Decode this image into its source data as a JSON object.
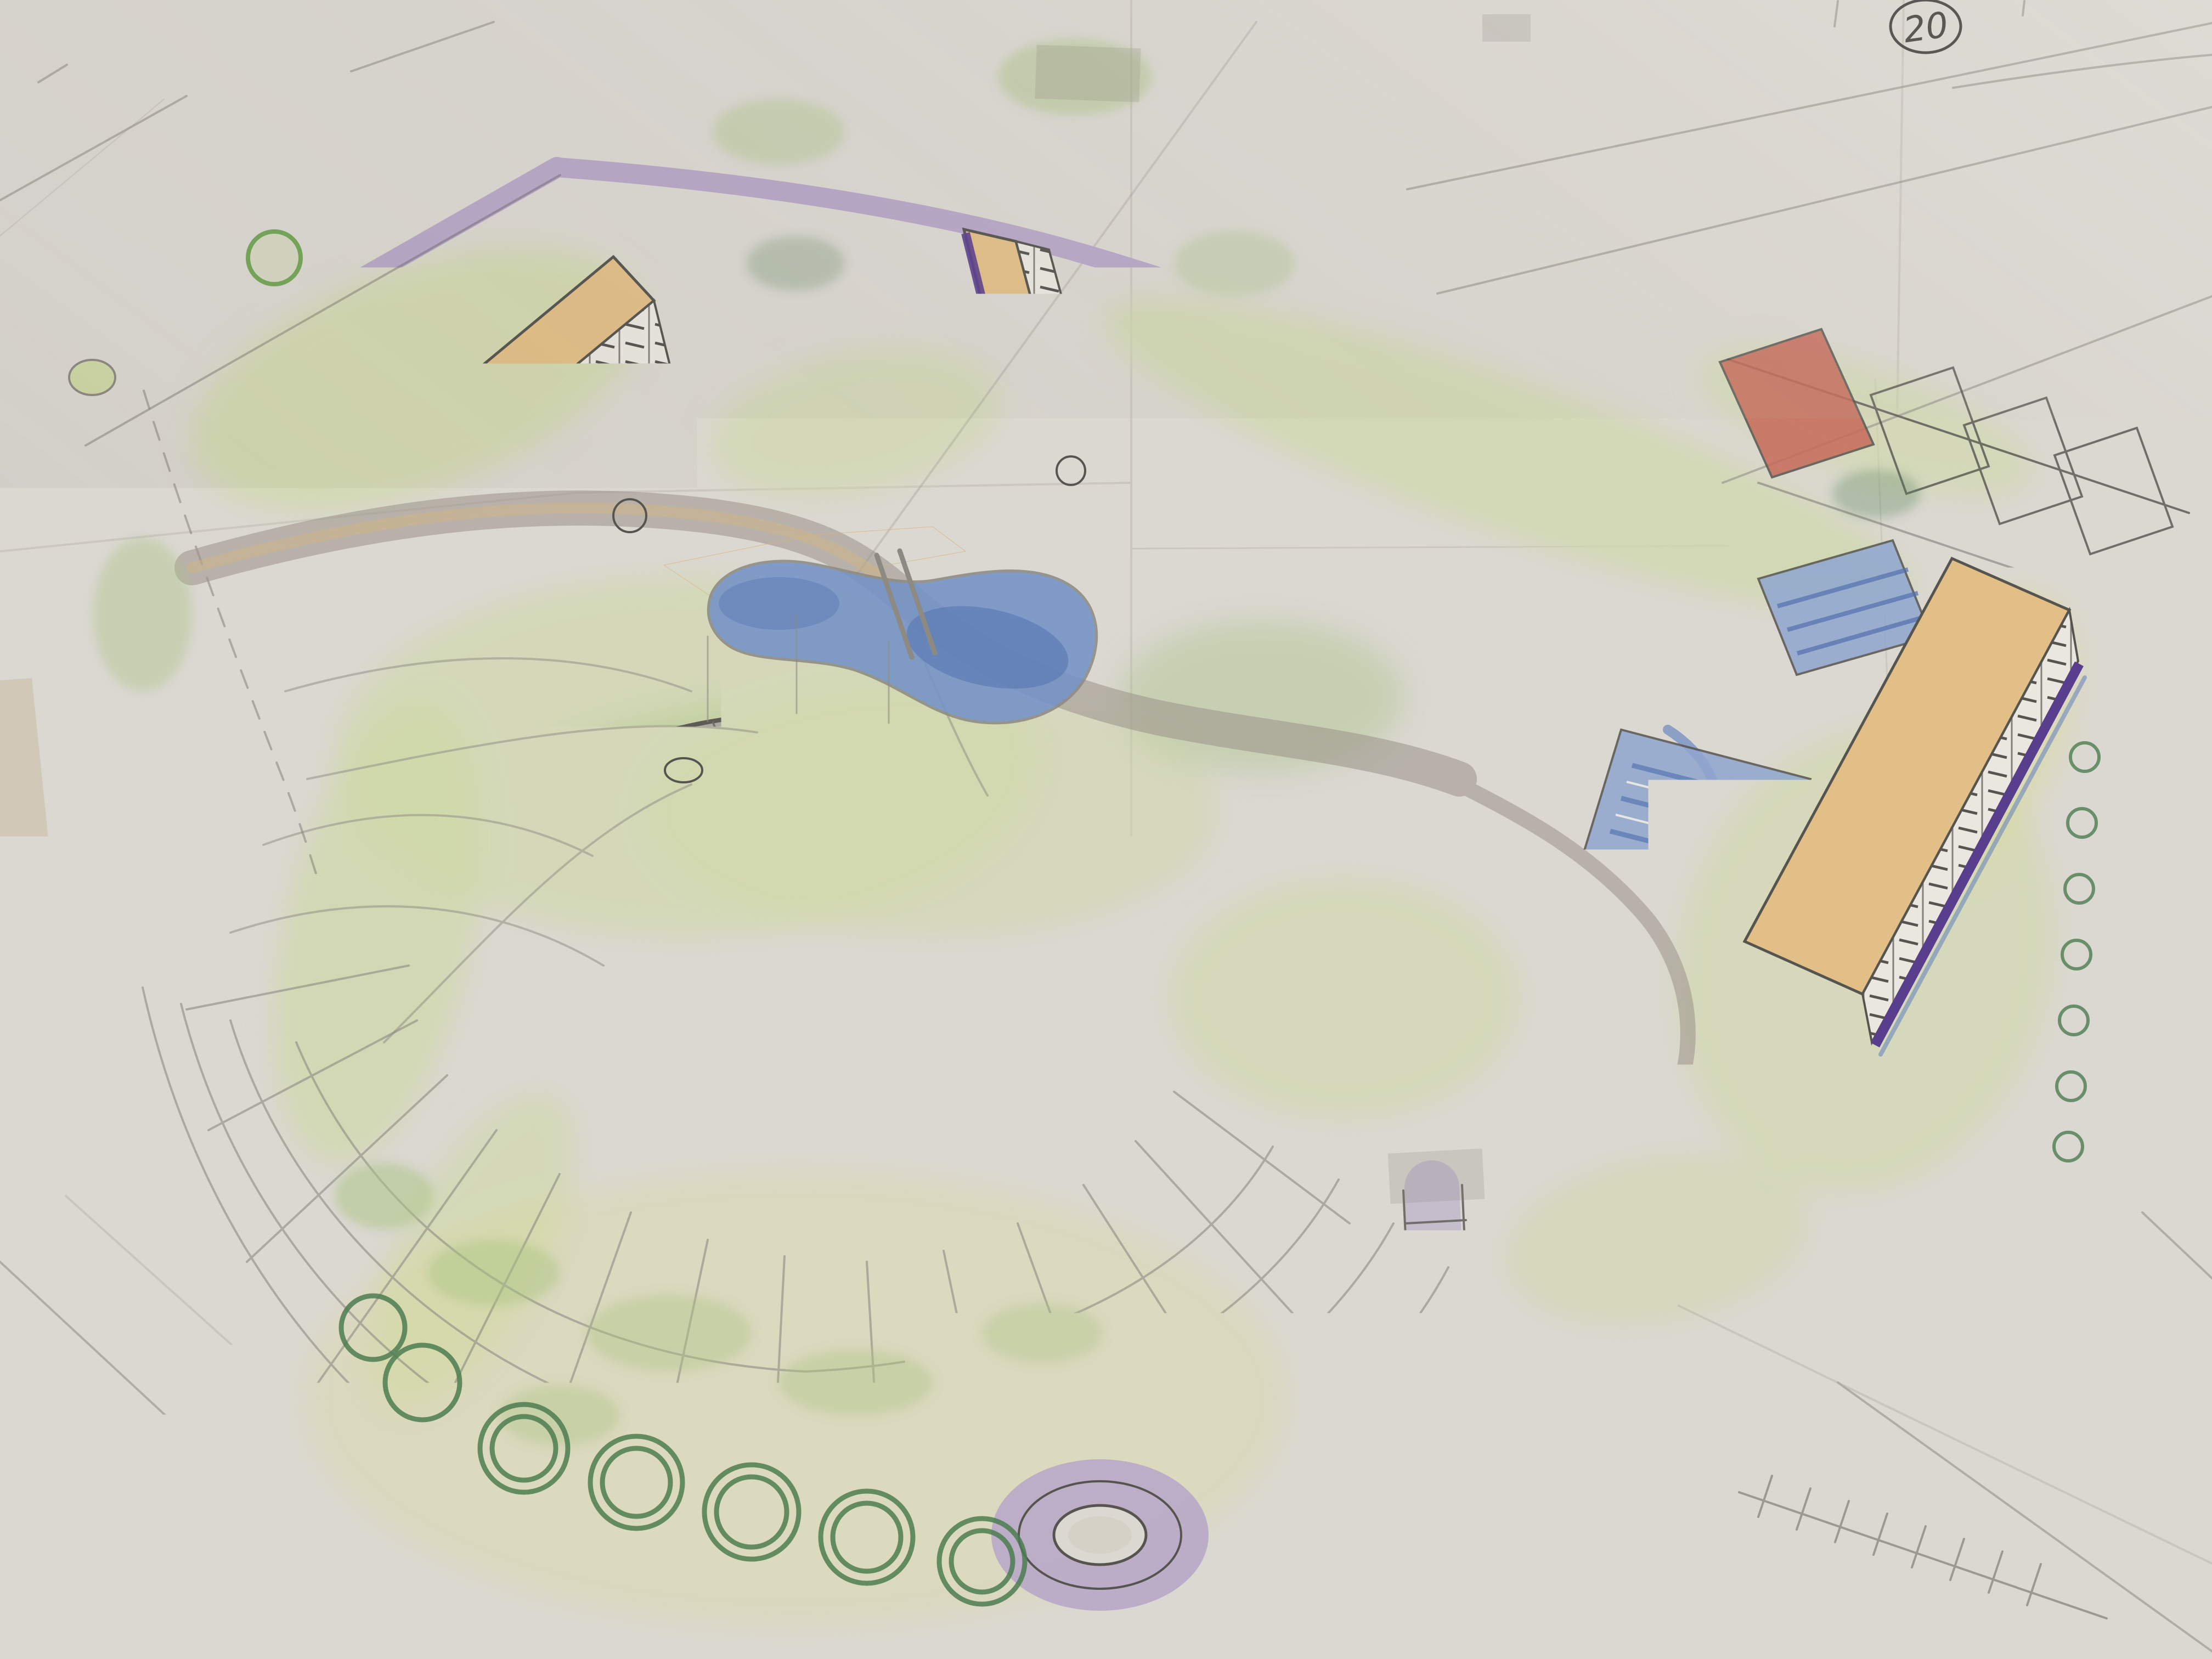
{
  "annotation": {
    "sheet_number": "20"
  },
  "scene": {
    "description": "hand-drawn colored-pencil aerial site sketch on taped paper sheets",
    "landmarks": [
      "domed-arena",
      "radial-plaza-paving",
      "bent-slab-building-nw",
      "bent-slab-building-n",
      "slab-building-e",
      "barrel-vault-hall-small",
      "barrel-vault-hall-large",
      "low-pavilion",
      "kidney-pond",
      "boulevard-with-u-turn",
      "roundabout",
      "tree-rows",
      "parking-stalls",
      "blue-courts",
      "swimming-pool",
      "red-court",
      "gridded-walkway"
    ]
  },
  "palette": {
    "paper": "#dbd8d2",
    "paper_light": "#e4e1db",
    "table": "#d2c8b8",
    "table_light": "#eae7e1",
    "graphite": "#56544f",
    "graphite_light": "#8d8a83",
    "lavender": "#b7a8c7",
    "purple_edge": "#84699e",
    "deep_purple": "#5a3e8e",
    "lawn": "#cfd8a6",
    "lawn_strong": "#a9c481",
    "lawn_yellow": "#dcdc92",
    "tree_line": "#74a658",
    "tree_dark": "#4d7d50",
    "pond": "#7492c6",
    "pond_dark": "#5270ae",
    "court": "#8fa6cf",
    "blue_shadow": "#6b87bd",
    "roof": "#e2bf87",
    "sand": "#d8b378",
    "red_court": "#c66a59",
    "facade": "#eae7e1",
    "road_gray": "#9a9288",
    "tape": "#8a857c"
  }
}
